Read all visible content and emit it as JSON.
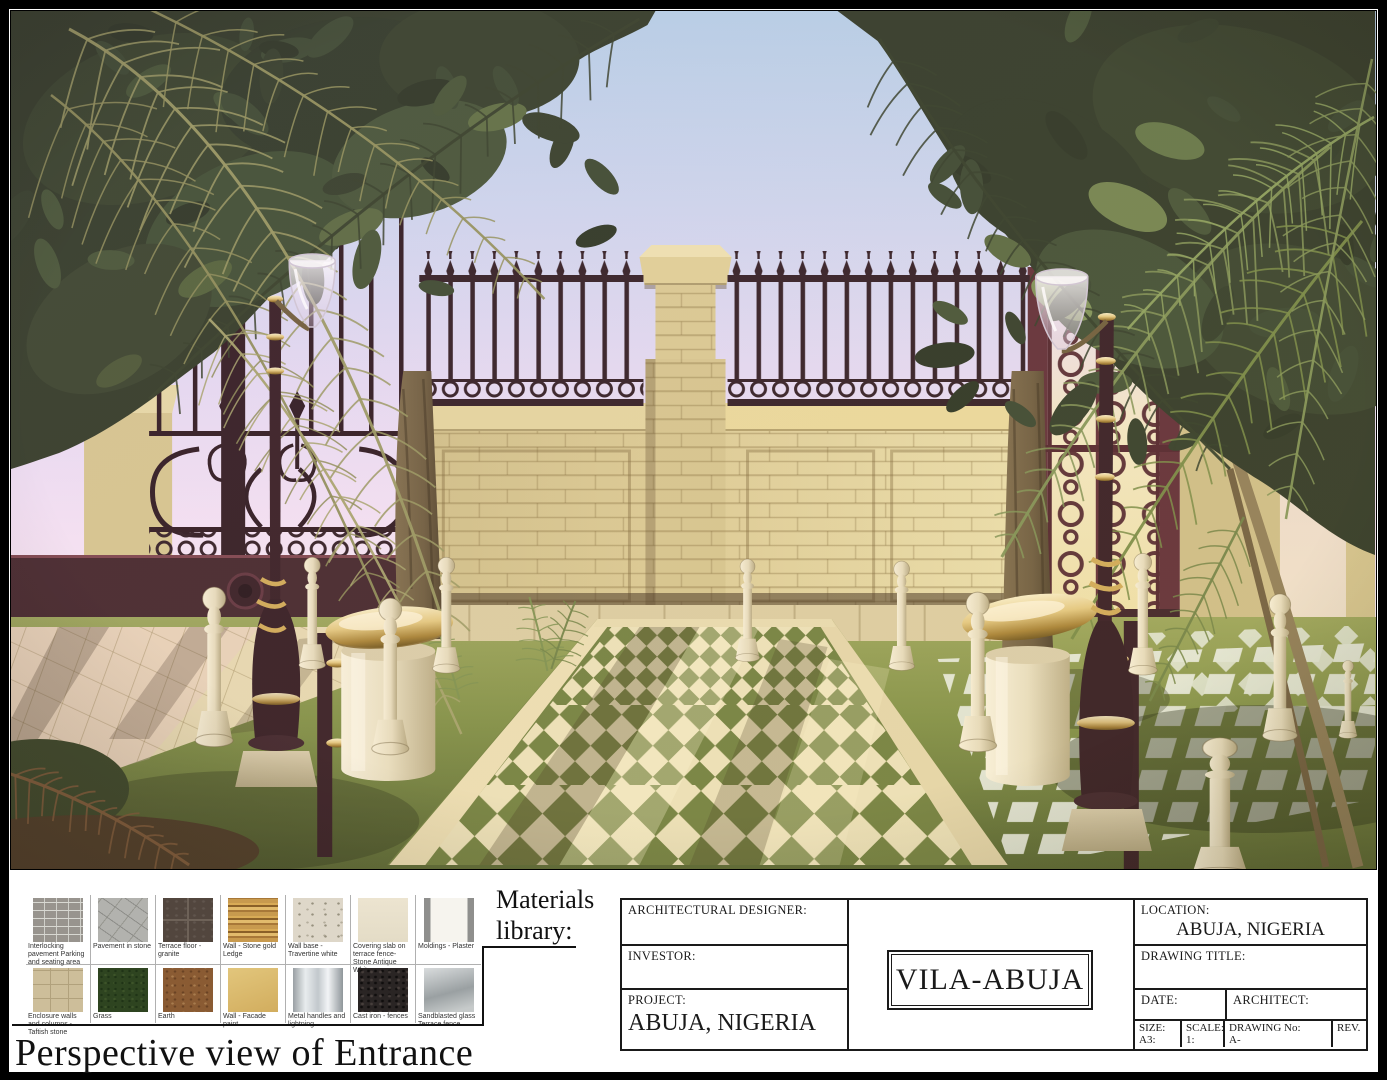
{
  "sheet_title": "Perspective view of Entrance",
  "materials_panel": {
    "heading": "Materials library:",
    "items": [
      {
        "label": "Interlocking pavement Parking and seating area",
        "swatch": "interlocking"
      },
      {
        "label": "Pavement in stone",
        "swatch": "flagstone"
      },
      {
        "label": "Terrace floor - granite",
        "swatch": "granite"
      },
      {
        "label": "Wall - Stone gold Ledge",
        "swatch": "gold-ledge"
      },
      {
        "label": "Wall base - Travertine white",
        "swatch": "travertine"
      },
      {
        "label": "Covering slab on terrace fence- Stone Antique White",
        "swatch": "antique-white"
      },
      {
        "label": "Moldings - Plaster",
        "swatch": "plaster"
      },
      {
        "label": "Enclosure walls and columns - Taftish stone",
        "swatch": "taftish-stone"
      },
      {
        "label": "Grass",
        "swatch": "grass"
      },
      {
        "label": "Earth",
        "swatch": "earth"
      },
      {
        "label": "Wall - Facade paint",
        "swatch": "facade-paint"
      },
      {
        "label": "Metal handles and lightning",
        "swatch": "metal"
      },
      {
        "label": "Cast iron - fences",
        "swatch": "cast-iron"
      },
      {
        "label": "Sandblasted glass Terrace fence",
        "swatch": "sandblasted-glass"
      }
    ]
  },
  "title_block": {
    "architectural_designer_label": "ARCHITECTURAL DESIGNER:",
    "investor_label": "INVESTOR:",
    "project_label": "PROJECT:",
    "project_value": "ABUJA, NIGERIA",
    "center_title": "VILA-ABUJA",
    "location_label": "LOCATION:",
    "location_value": "ABUJA, NIGERIA",
    "drawing_title_label": "DRAWING  TITLE:",
    "date_label": "DATE:",
    "architect_label": "ARCHITECT:",
    "size_label": "SIZE:",
    "size_value": "A3:",
    "scale_label": "SCALE:",
    "scale_value": "1:",
    "drawing_no_label": "DRAWING No:",
    "drawing_no_value": "A-",
    "rev_label": "REV."
  },
  "scene": {
    "subject": "perspective-render-of-villa-entrance",
    "colors": {
      "sky_top": "#b4cfe6",
      "sky_horizon": "#f9ebf3",
      "stone_wall": "#dccc92",
      "iron_fence": "#2d191e",
      "burgundy_gate": "#5d2a31",
      "grass": "#7e8f41",
      "path_tile": "#ece2b6",
      "lamp_post": "#31181d",
      "brass": "#e3c87c",
      "bollard_cream": "#f0e8cf",
      "canopy_dark_green": "#2c3620",
      "palm_olive": "#97975c"
    }
  }
}
